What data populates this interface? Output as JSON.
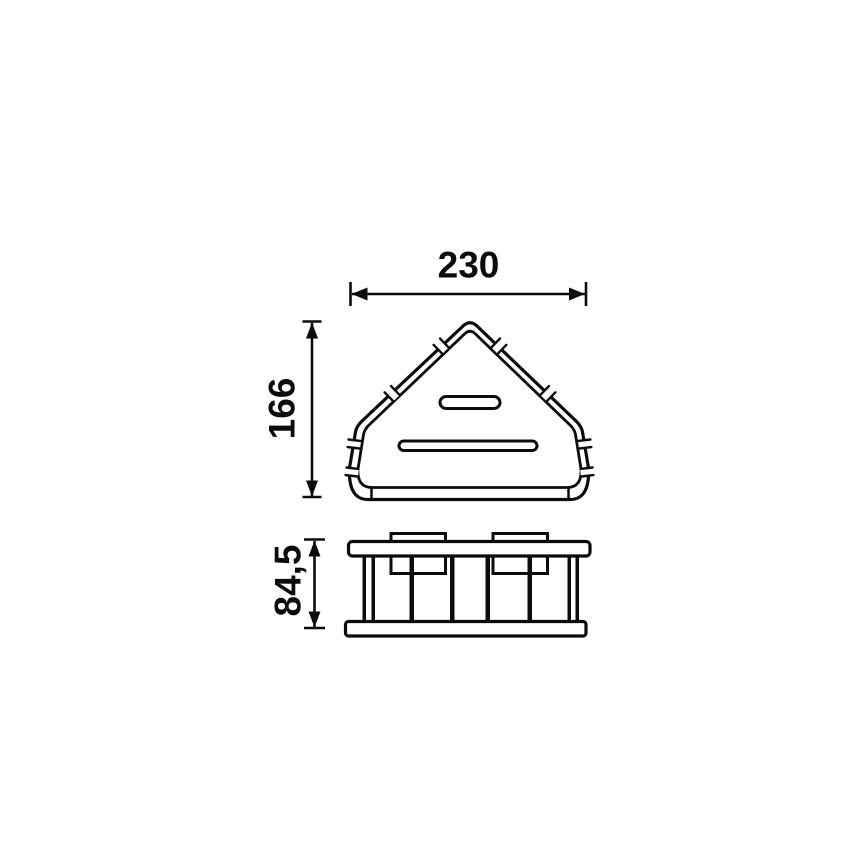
{
  "page": {
    "background_color": "#ffffff",
    "line_color": "#0c0c0c"
  },
  "drawing": {
    "kind": "technical dimension drawing",
    "views": {
      "top_view": "triangular corner basket seen from above",
      "front_view": "basket side profile with rails, vertical wires and two wall brackets"
    },
    "dimensions": {
      "width": {
        "label": "230"
      },
      "height": {
        "label": "166"
      },
      "depth": {
        "label": "84,5"
      }
    }
  }
}
